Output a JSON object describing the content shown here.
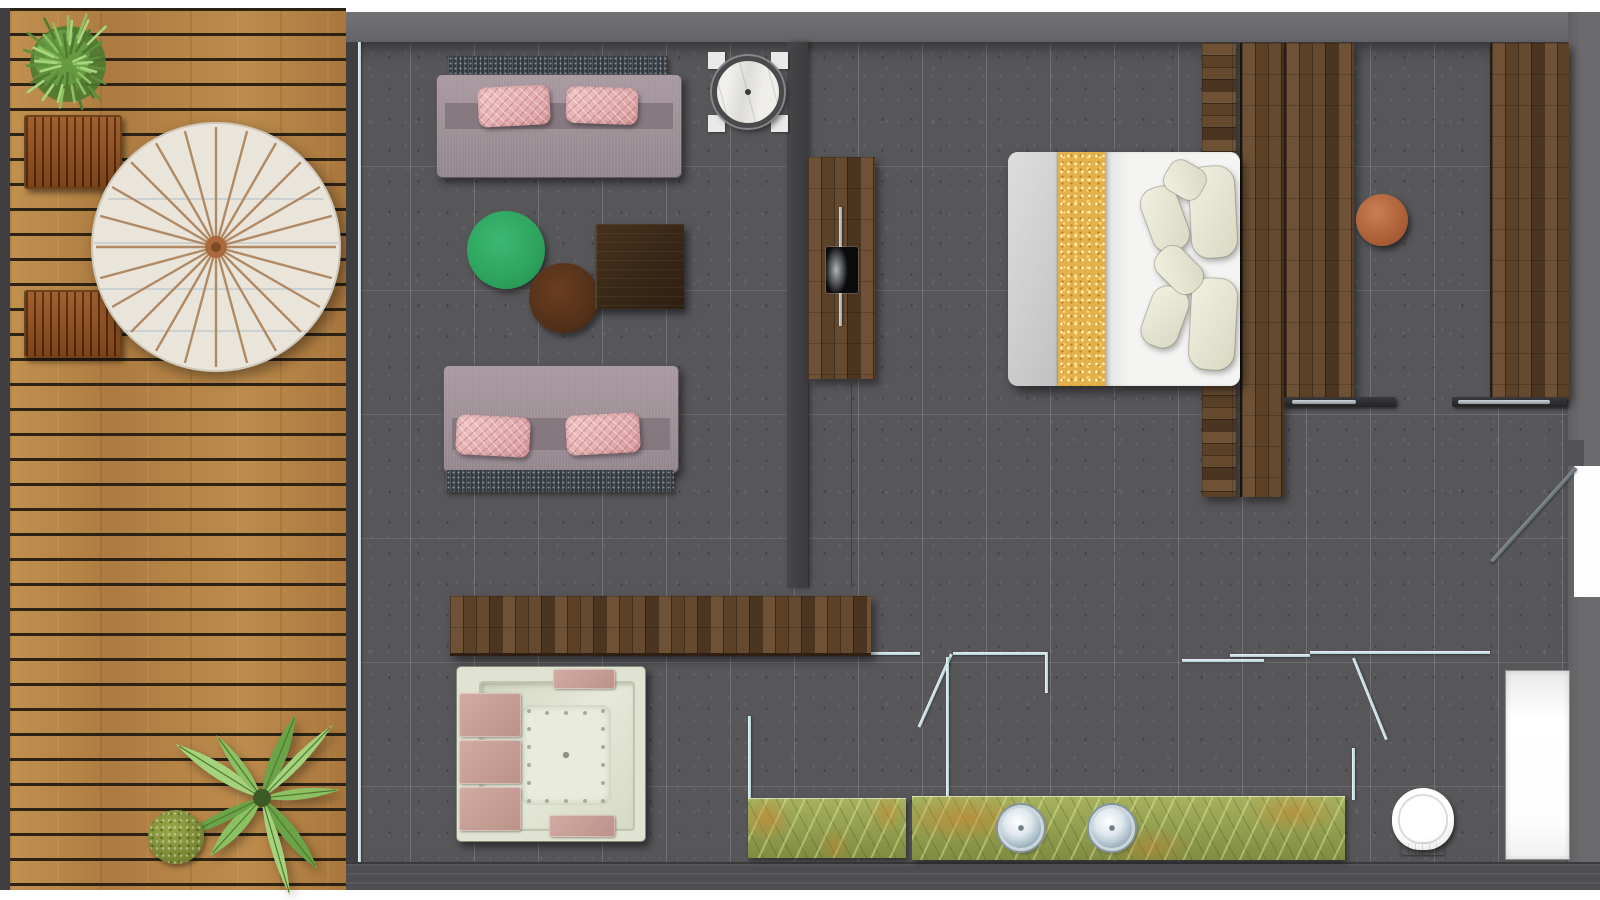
{
  "meta": {
    "kind": "hotel-suite floor plan, photoreal top-down render",
    "rooms": [
      "terrace-deck",
      "living-area",
      "bedroom",
      "bathroom"
    ],
    "visible_text": "none"
  },
  "palette": {
    "page_bg": "#ffffff",
    "wall": "#6b6b6d",
    "wall_dark": "#3f3f41",
    "wall_bottom": "#4e4e50",
    "floor": "#57575a",
    "deck_wood": "#b5854a",
    "deck_gap": "#2c2315",
    "glass": "#cfe4e9",
    "walnut": "#5a4128",
    "sofa_band": "#7e7077",
    "sofa_fringe": "#343a42",
    "pillow_pink": "#e8b9ba",
    "table_green": "#2da35e",
    "ottoman_brown": "#52301a",
    "coffee_table": "#3a2817",
    "marble": "#eceae6",
    "marble_rim": "#4a4a4c",
    "gold": "#e3b04a",
    "pillow_cream": "#ecead9",
    "stool": "#b4673f",
    "tub_shell": "#e0e3d1",
    "tub_floor": "#e9ecdc",
    "onyx": "#97a251",
    "chrome": "#9fb4c0",
    "leaf_green": "#7db85a",
    "leaf_dark": "#5b8f3c",
    "parasol_rib": "#b08a64",
    "parasol_canopy": "#eae5da"
  },
  "deck": {
    "planks_direction": "horizontal",
    "sun_loungers": 2,
    "parasol": {
      "spokes": 24,
      "stripe_lines": 4
    },
    "shrub": {
      "tufts": 48
    },
    "moss": {
      "tufts": 26
    },
    "fern": {
      "fronds": 9
    }
  },
  "living": {
    "sofas": 2,
    "pillows_per_sofa": 2,
    "tables": [
      "round-marble-side-table",
      "round-green-table",
      "round-brown-ottoman",
      "square-dark-coffee-table"
    ],
    "tv_unit": {
      "screen": 1,
      "media_rail": 1
    },
    "console_bench": 1
  },
  "bedroom": {
    "double_bed": 1,
    "bed_pillows": 6,
    "gold_runner": true,
    "wardrobe_columns": 3,
    "sliding_door_handles": 2,
    "bedside_stool": 1
  },
  "bathroom": {
    "jacuzzi": {
      "jets": 18,
      "headrest_pads": 3,
      "edge_pads": 2
    },
    "vanity_sinks": 2,
    "vanity_segments": 2,
    "toilet": 1,
    "glass_doors": 2,
    "sliding_glass_panels": 2,
    "shower_niche": 1,
    "entry_door": 1
  }
}
